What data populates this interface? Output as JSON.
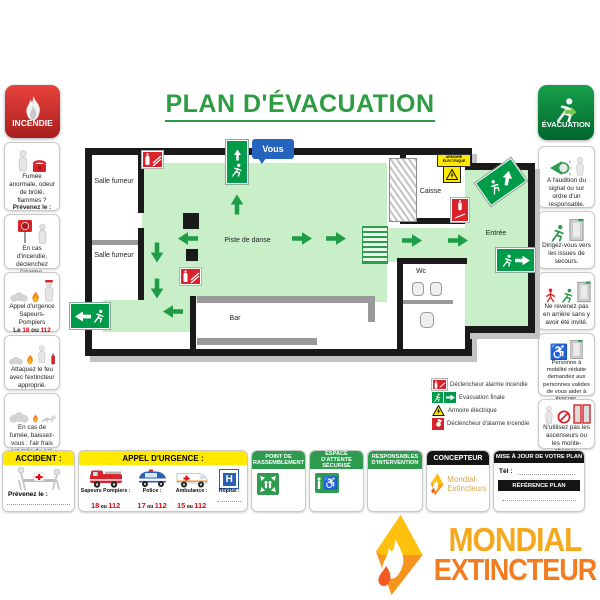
{
  "title": "PLAN D'ÉVACUATION",
  "colors": {
    "green": "#2E9C4E",
    "red": "#D8232A",
    "yellow": "#FFE900",
    "blue": "#2563BE",
    "orange": "#F47C20",
    "gold": "#F5A81C",
    "floor": "#C9EFC9"
  },
  "incendie": {
    "badge": "INCENDIE",
    "cards": [
      {
        "text": "Fumée anormale, odeur de brûlé, flammes ?",
        "bold": "Prévenez le :"
      },
      {
        "text": "En cas d'incendie, déclenchez l'alarme."
      },
      {
        "text": "Appel d'urgence Sapeurs-Pompiers",
        "prefix": "Le",
        "n1": "18",
        "sep": "ou",
        "n2": "112"
      },
      {
        "text": "Attaquez le feu avec l'extincteur approprié."
      },
      {
        "text": "En cas de fumée, baissez-vous : l'air frais est près du sol."
      }
    ]
  },
  "evacuation": {
    "badge": "ÉVACUATION",
    "cards": [
      {
        "text": "A l'audition du signal ou sur ordre d'un responsable."
      },
      {
        "text": "Dirigez-vous vers les issues de secours."
      },
      {
        "text": "Ne revenez pas en arrière sans y avoir été invité."
      },
      {
        "text": "Personne à mobilité réduite demandez aux personnes valides de vous aider à évacuer."
      },
      {
        "text": "N'utilisez pas les ascenseurs ou les monte-charges."
      }
    ]
  },
  "plan": {
    "you_are_here": "Vous",
    "rooms": {
      "salle_fumeur_1": "Salle fumeur",
      "salle_fumeur_2": "Salle fumeur",
      "piste": "Piste de danse",
      "bar": "Bar",
      "caisse": "Caisse",
      "wc": "Wc",
      "entree": "Entrée"
    },
    "armoire_label": "ARMOIRE ÉLECTRIQUE"
  },
  "legend": {
    "items": [
      "Déclencheur alarme incendie",
      "Evacuation finale",
      "Armoire électrique",
      "Déclencheur d'alarme incendie"
    ]
  },
  "accident": {
    "header": "ACCIDENT :",
    "bold": "Prévenez le :"
  },
  "urgence": {
    "header": "APPEL D'URGENCE :",
    "entries": [
      {
        "label": "Sapeurs Pompiers :",
        "n1": "18",
        "sep": "ou",
        "n2": "112"
      },
      {
        "label": "Police :",
        "n1": "17",
        "sep": "ou",
        "n2": "112"
      },
      {
        "label": "Ambulance :",
        "n1": "15",
        "sep": "ou",
        "n2": "112"
      },
      {
        "label": "Hôpital :"
      }
    ]
  },
  "panels": {
    "rassemblement": "POINT DE RASSEMBLEMENT",
    "attente": "ESPACE D'ATTENTE SÉCURISÉ",
    "responsables": "RESPONSABLES D'INTERVENTION",
    "concepteur": {
      "header": "CONCEPTEUR",
      "brand1": "Mondial",
      "brand2": "Extincteurs"
    },
    "mise_a_jour": {
      "header": "MISE À JOUR DE VOTRE PLAN",
      "tel": "Tél :",
      "ref": "RÉFÉRENCE PLAN"
    }
  },
  "brand": {
    "line1": "MONDIAL",
    "line2": "EXTINCTEUR"
  }
}
